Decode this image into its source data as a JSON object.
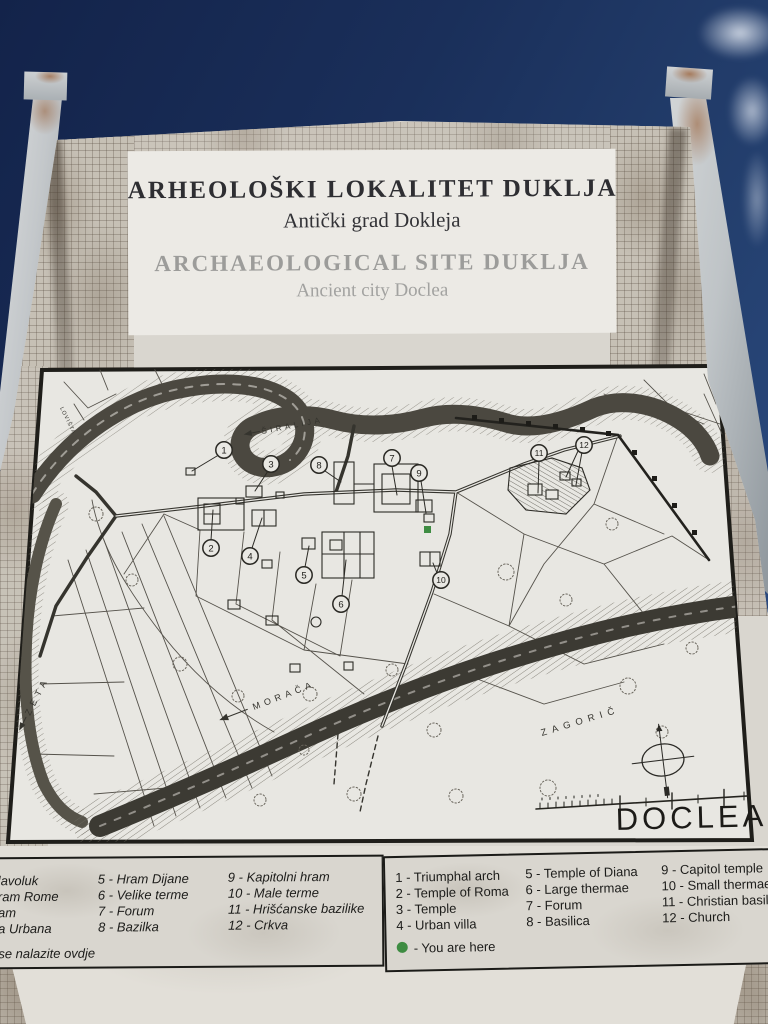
{
  "sign": {
    "title_local": "ARHEOLOŠKI LOKALITET DUKLJA",
    "subtitle_local": "Antički grad Dokleja",
    "title_en": "ARCHAEOLOGICAL SITE DUKLJA",
    "subtitle_en": "Ancient city Doclea"
  },
  "map": {
    "name": "DOCLEA",
    "labels": {
      "river_top": "ŠIRALIJA",
      "river_left": "ZETA",
      "river_bottom": "MORAČA",
      "area": "ZAGORIČ",
      "small": "LOVIŠTA"
    },
    "markers": [
      "1",
      "2",
      "3",
      "4",
      "5",
      "6",
      "7",
      "8",
      "9",
      "10",
      "11",
      "12"
    ]
  },
  "legend_local": {
    "col1": [
      "lavoluk",
      "ram Rome",
      "am",
      "a Urbana"
    ],
    "col2": [
      "5 - Hram Dijane",
      "6 - Velike terme",
      "7 - Forum",
      "8 - Bazilka"
    ],
    "col3": [
      "9 - Kapitolni hram",
      "10 - Male terme",
      "11 - Hrišćanske bazilike",
      "12 - Crkva"
    ],
    "footer": "se nalazite ovdje"
  },
  "legend_en": {
    "col1": [
      "1 - Triumphal arch",
      "2 - Temple of Roma",
      "3 - Temple",
      "4 - Urban villa"
    ],
    "col2": [
      "5 - Temple of Diana",
      "6 - Large thermae",
      "7 - Forum",
      "8 - Basilica"
    ],
    "col3": [
      "9 - Capitol temple",
      "10 - Small thermae",
      "11 - Christian basilic",
      "12 - Church"
    ],
    "footer": "- You are here"
  },
  "colors": {
    "you_are_here": "#3e8c42",
    "sky_top": "#13234a",
    "sky_bottom": "#2b4b82",
    "mosaic": "#c6c0b5",
    "paper": "#e2dfd8",
    "ink": "#2c2b26",
    "title_gray": "#9c9c9a"
  }
}
